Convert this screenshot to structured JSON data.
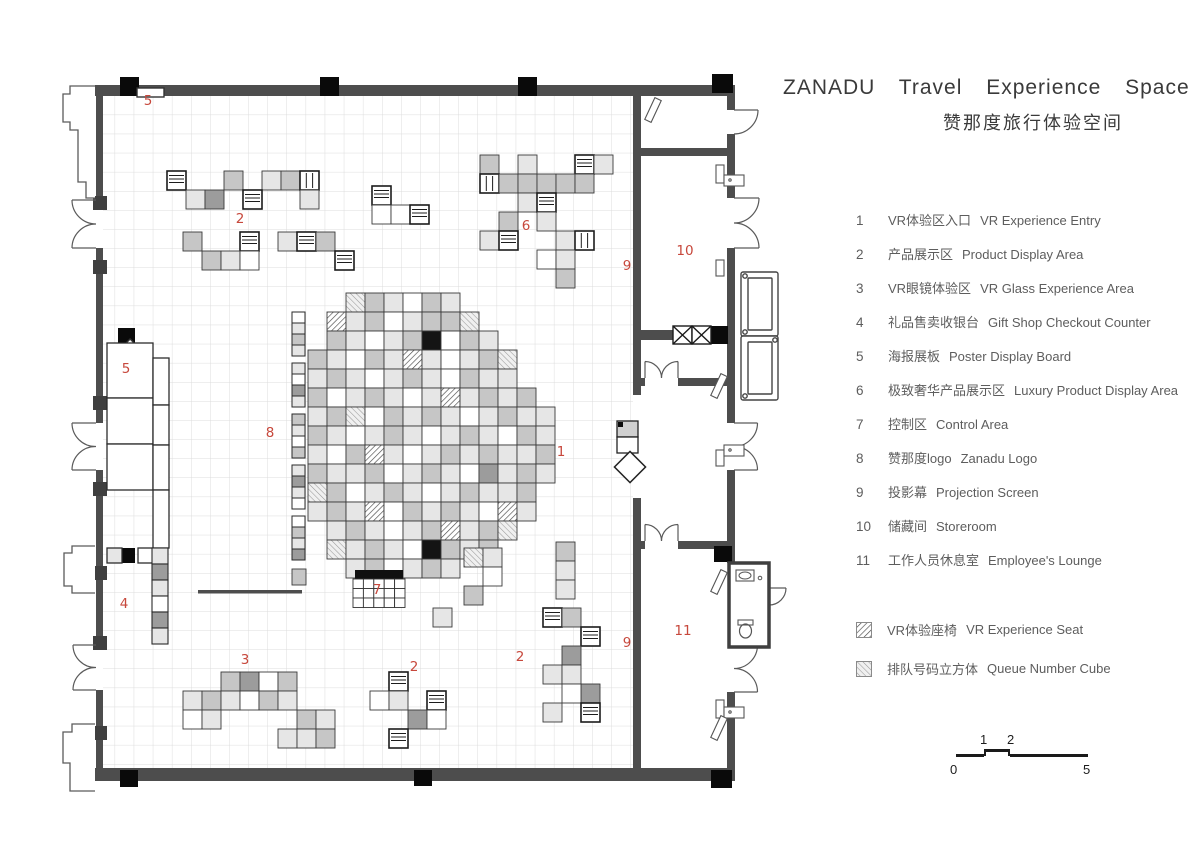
{
  "title": {
    "en": "ZANADU Travel Experience Space",
    "zh": "赞那度旅行体验空间"
  },
  "legend": {
    "items": [
      {
        "num": "1",
        "zh": "VR体验区入口",
        "en": "VR Experience Entry"
      },
      {
        "num": "2",
        "zh": "产品展示区",
        "en": "Product Display Area"
      },
      {
        "num": "3",
        "zh": "VR眼镜体验区",
        "en": "VR Glass Experience Area"
      },
      {
        "num": "4",
        "zh": "礼品售卖收银台",
        "en": "Gift Shop Checkout Counter"
      },
      {
        "num": "5",
        "zh": "海报展板",
        "en": "Poster Display Board"
      },
      {
        "num": "6",
        "zh": "极致奢华产品展示区",
        "en": "Luxury Product Display Area"
      },
      {
        "num": "7",
        "zh": "控制区",
        "en": "Control Area"
      },
      {
        "num": "8",
        "zh": "赞那度logo",
        "en": "Zanadu Logo"
      },
      {
        "num": "9",
        "zh": "投影幕",
        "en": "Projection Screen"
      },
      {
        "num": "10",
        "zh": "储藏间",
        "en": "Storeroom"
      },
      {
        "num": "11",
        "zh": "工作人员休息室",
        "en": "Employee's Lounge"
      }
    ],
    "textures": [
      {
        "swatch": "hatch-seat",
        "zh": "VR体验座椅",
        "en": "VR Experience Seat"
      },
      {
        "swatch": "hatch-queue",
        "zh": "排队号码立方体",
        "en": "Queue Number Cube"
      }
    ]
  },
  "scalebar": {
    "above": [
      "1",
      "2"
    ],
    "below": [
      "0",
      "5"
    ]
  },
  "plan": {
    "accent": "#c7483c",
    "labels": [
      {
        "t": "5",
        "x": 148,
        "y": 105
      },
      {
        "t": "2",
        "x": 240,
        "y": 223
      },
      {
        "t": "6",
        "x": 526,
        "y": 230
      },
      {
        "t": "9",
        "x": 627,
        "y": 270
      },
      {
        "t": "10",
        "x": 685,
        "y": 255
      },
      {
        "t": "5",
        "x": 126,
        "y": 373
      },
      {
        "t": "8",
        "x": 270,
        "y": 437
      },
      {
        "t": "1",
        "x": 561,
        "y": 456
      },
      {
        "t": "7",
        "x": 377,
        "y": 594
      },
      {
        "t": "4",
        "x": 124,
        "y": 608
      },
      {
        "t": "9",
        "x": 627,
        "y": 647
      },
      {
        "t": "11",
        "x": 683,
        "y": 635
      },
      {
        "t": "3",
        "x": 245,
        "y": 664
      },
      {
        "t": "2",
        "x": 414,
        "y": 671
      },
      {
        "t": "2",
        "x": 520,
        "y": 661
      }
    ],
    "blob": {
      "x": 308,
      "y": 293,
      "cell": 19,
      "rows": [
        "..qmlwml......",
        ".hlmwlmmq.....",
        ".mlwlmbwml....",
        "mlwmlhlwlmq...",
        "lmlwlmlwmll...",
        "mwlmlwlhlmlm..",
        "lmqwmlmlwlmll.",
        "mlwlmlwlmlwml.",
        "lwmhlwlmlmllm.",
        "mllmwlmlwdlml.",
        "qmwlmlwlmllm..",
        "lmlhwmlmlwhl..",
        ".lmlwlmhlmq...",
        ".qlmlwbmlm....",
        "..lmwlml......"
      ]
    },
    "clusters": [
      {
        "id": "display-2-top",
        "x": 167,
        "y": 171,
        "cells": [
          [
            0,
            0,
            "s"
          ],
          [
            3,
            0,
            "m"
          ],
          [
            5,
            0,
            "l"
          ],
          [
            6,
            0,
            "m"
          ],
          [
            7,
            0,
            "v"
          ],
          [
            1,
            1,
            "l"
          ],
          [
            2,
            1,
            "d"
          ],
          [
            4,
            1,
            "s"
          ],
          [
            7,
            1,
            "l"
          ]
        ]
      },
      {
        "id": "display-2-top-b",
        "x": 183,
        "y": 232,
        "cells": [
          [
            0,
            0,
            "m"
          ],
          [
            3,
            0,
            "s"
          ],
          [
            5,
            0,
            "l"
          ],
          [
            6,
            0,
            "s"
          ],
          [
            7,
            0,
            "m"
          ],
          [
            1,
            1,
            "m"
          ],
          [
            2,
            1,
            "l"
          ],
          [
            3,
            1,
            "w"
          ],
          [
            8,
            1,
            "s"
          ]
        ]
      },
      {
        "id": "display-mid-top",
        "x": 372,
        "y": 186,
        "cells": [
          [
            0,
            0,
            "s"
          ],
          [
            0,
            1,
            "w"
          ],
          [
            1,
            1,
            "w"
          ],
          [
            2,
            1,
            "s"
          ]
        ]
      },
      {
        "id": "display-6-luxury",
        "x": 480,
        "y": 155,
        "cells": [
          [
            0,
            0,
            "m"
          ],
          [
            2,
            0,
            "l"
          ],
          [
            5,
            0,
            "s"
          ],
          [
            6,
            0,
            "l"
          ],
          [
            0,
            1,
            "v"
          ],
          [
            1,
            1,
            "m"
          ],
          [
            2,
            1,
            "m"
          ],
          [
            3,
            1,
            "m"
          ],
          [
            4,
            1,
            "m"
          ],
          [
            5,
            1,
            "m"
          ],
          [
            2,
            2,
            "l"
          ],
          [
            3,
            2,
            "s"
          ],
          [
            1,
            3,
            "m"
          ],
          [
            3,
            3,
            "l"
          ],
          [
            0,
            4,
            "l"
          ],
          [
            1,
            4,
            "s"
          ],
          [
            4,
            4,
            "l"
          ],
          [
            5,
            4,
            "v"
          ],
          [
            3,
            5,
            "w"
          ],
          [
            4,
            5,
            "l"
          ],
          [
            4,
            6,
            "m"
          ]
        ]
      },
      {
        "id": "display-3-glasses",
        "x": 183,
        "y": 672,
        "cells": [
          [
            2,
            0,
            "m"
          ],
          [
            3,
            0,
            "d"
          ],
          [
            4,
            0,
            "w"
          ],
          [
            5,
            0,
            "m"
          ],
          [
            0,
            1,
            "l"
          ],
          [
            1,
            1,
            "m"
          ],
          [
            2,
            1,
            "l"
          ],
          [
            3,
            1,
            "w"
          ],
          [
            4,
            1,
            "m"
          ],
          [
            5,
            1,
            "l"
          ],
          [
            0,
            2,
            "w"
          ],
          [
            1,
            2,
            "l"
          ],
          [
            6,
            2,
            "m"
          ],
          [
            7,
            2,
            "l"
          ],
          [
            5,
            3,
            "l"
          ],
          [
            6,
            3,
            "l"
          ],
          [
            7,
            3,
            "m"
          ]
        ]
      },
      {
        "id": "display-2-bottom",
        "x": 370,
        "y": 672,
        "cells": [
          [
            1,
            0,
            "s"
          ],
          [
            0,
            1,
            "w"
          ],
          [
            1,
            1,
            "l"
          ],
          [
            3,
            1,
            "s"
          ],
          [
            2,
            2,
            "d"
          ],
          [
            3,
            2,
            "w"
          ],
          [
            1,
            3,
            "s"
          ]
        ]
      },
      {
        "id": "display-2-right",
        "x": 543,
        "y": 608,
        "cells": [
          [
            0,
            0,
            "s"
          ],
          [
            1,
            0,
            "m"
          ],
          [
            2,
            1,
            "s"
          ],
          [
            1,
            2,
            "d"
          ],
          [
            0,
            3,
            "l"
          ],
          [
            1,
            3,
            "l"
          ],
          [
            2,
            4,
            "d"
          ],
          [
            1,
            4,
            "w"
          ],
          [
            0,
            5,
            "l"
          ],
          [
            2,
            5,
            "s"
          ]
        ]
      },
      {
        "id": "blob-tail",
        "x": 464,
        "y": 548,
        "cells": [
          [
            0,
            0,
            "q"
          ],
          [
            1,
            0,
            "l"
          ],
          [
            1,
            1,
            "w"
          ],
          [
            0,
            2,
            "m"
          ]
        ]
      },
      {
        "id": "detached-right",
        "x": 556,
        "y": 542,
        "cells": [
          [
            0,
            0,
            "m"
          ],
          [
            0,
            1,
            "l"
          ],
          [
            0,
            2,
            "l"
          ]
        ]
      },
      {
        "id": "lone-cube",
        "x": 433,
        "y": 608,
        "cells": [
          [
            0,
            0,
            "l"
          ]
        ]
      }
    ],
    "logo_strip": {
      "x": 292,
      "y": 312,
      "w": 13,
      "cell_h": 11,
      "gap": 7,
      "groups": [
        [
          "w",
          "l",
          "m",
          "l"
        ],
        [
          "l",
          "w",
          "d",
          "l"
        ],
        [
          "m",
          "l",
          "w",
          "m"
        ],
        [
          "l",
          "d",
          "l",
          "w"
        ],
        [
          "w",
          "m",
          "l",
          "d"
        ]
      ]
    },
    "gift_stack": {
      "x": 152,
      "y": 548,
      "w": 16,
      "cell_h": 16,
      "fills": [
        "l",
        "d",
        "l",
        "w",
        "d",
        "l"
      ]
    },
    "control": {
      "x": 353,
      "y": 570,
      "bar_w": 52,
      "bar_h": 9,
      "cols": 5,
      "rows": 3,
      "cell_w": 10.4,
      "cell_h": 9.5
    }
  }
}
